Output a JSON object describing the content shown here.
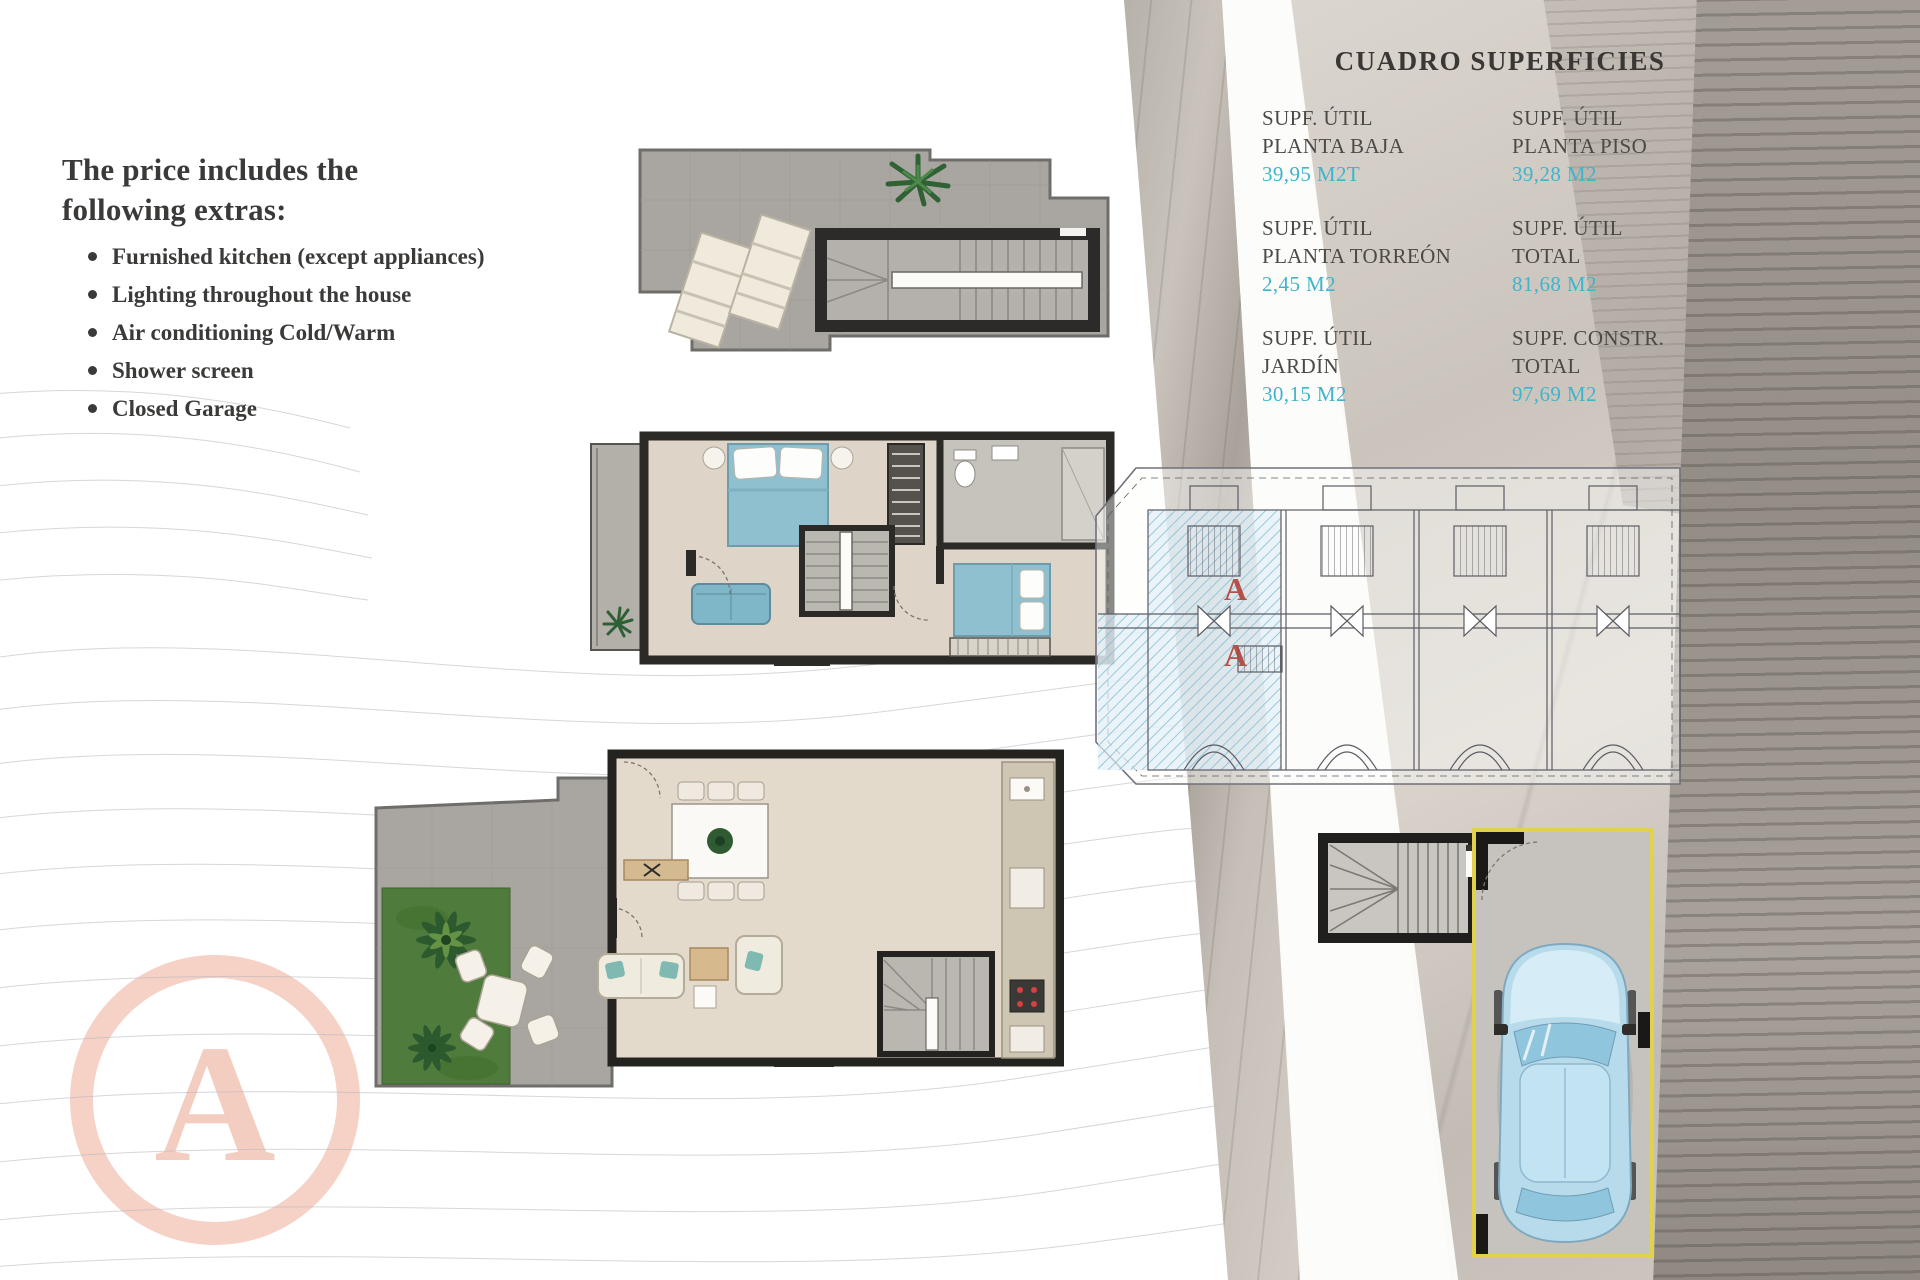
{
  "left_panel": {
    "heading_lines": [
      "The price includes the",
      "following extras:"
    ],
    "bullets": [
      "Furnished kitchen (except appliances)",
      "Lighting throughout the house",
      "Air conditioning Cold/Warm",
      "Shower screen",
      "Closed Garage"
    ]
  },
  "surfaces_table": {
    "title": "CUADRO SUPERFICIES",
    "cells": [
      {
        "label_lines": [
          "SUPF. ÚTIL",
          "PLANTA BAJA"
        ],
        "value": "39,95 M2T"
      },
      {
        "label_lines": [
          "SUPF. ÚTIL",
          "PLANTA PISO"
        ],
        "value": "39,28 M2"
      },
      {
        "label_lines": [
          "SUPF. ÚTIL",
          "PLANTA TORREÓN"
        ],
        "value": "2,45 M2"
      },
      {
        "label_lines": [
          "SUPF. ÚTIL",
          "TOTAL"
        ],
        "value": "81,68 M2"
      },
      {
        "label_lines": [
          "SUPF. ÚTIL",
          "JARDÍN"
        ],
        "value": "30,15 M2"
      },
      {
        "label_lines": [
          "SUPF. CONSTR.",
          "TOTAL"
        ],
        "value": "97,69 M2"
      }
    ]
  },
  "site_plan": {
    "markers": [
      "A",
      "A"
    ]
  },
  "watermark": {
    "letter": "A"
  },
  "colors": {
    "value_accent": "#3fb4cd",
    "marker_red": "#b0423c",
    "watermark_salmon": "#f4c9bc",
    "garage_yellow": "#e0d24c"
  }
}
